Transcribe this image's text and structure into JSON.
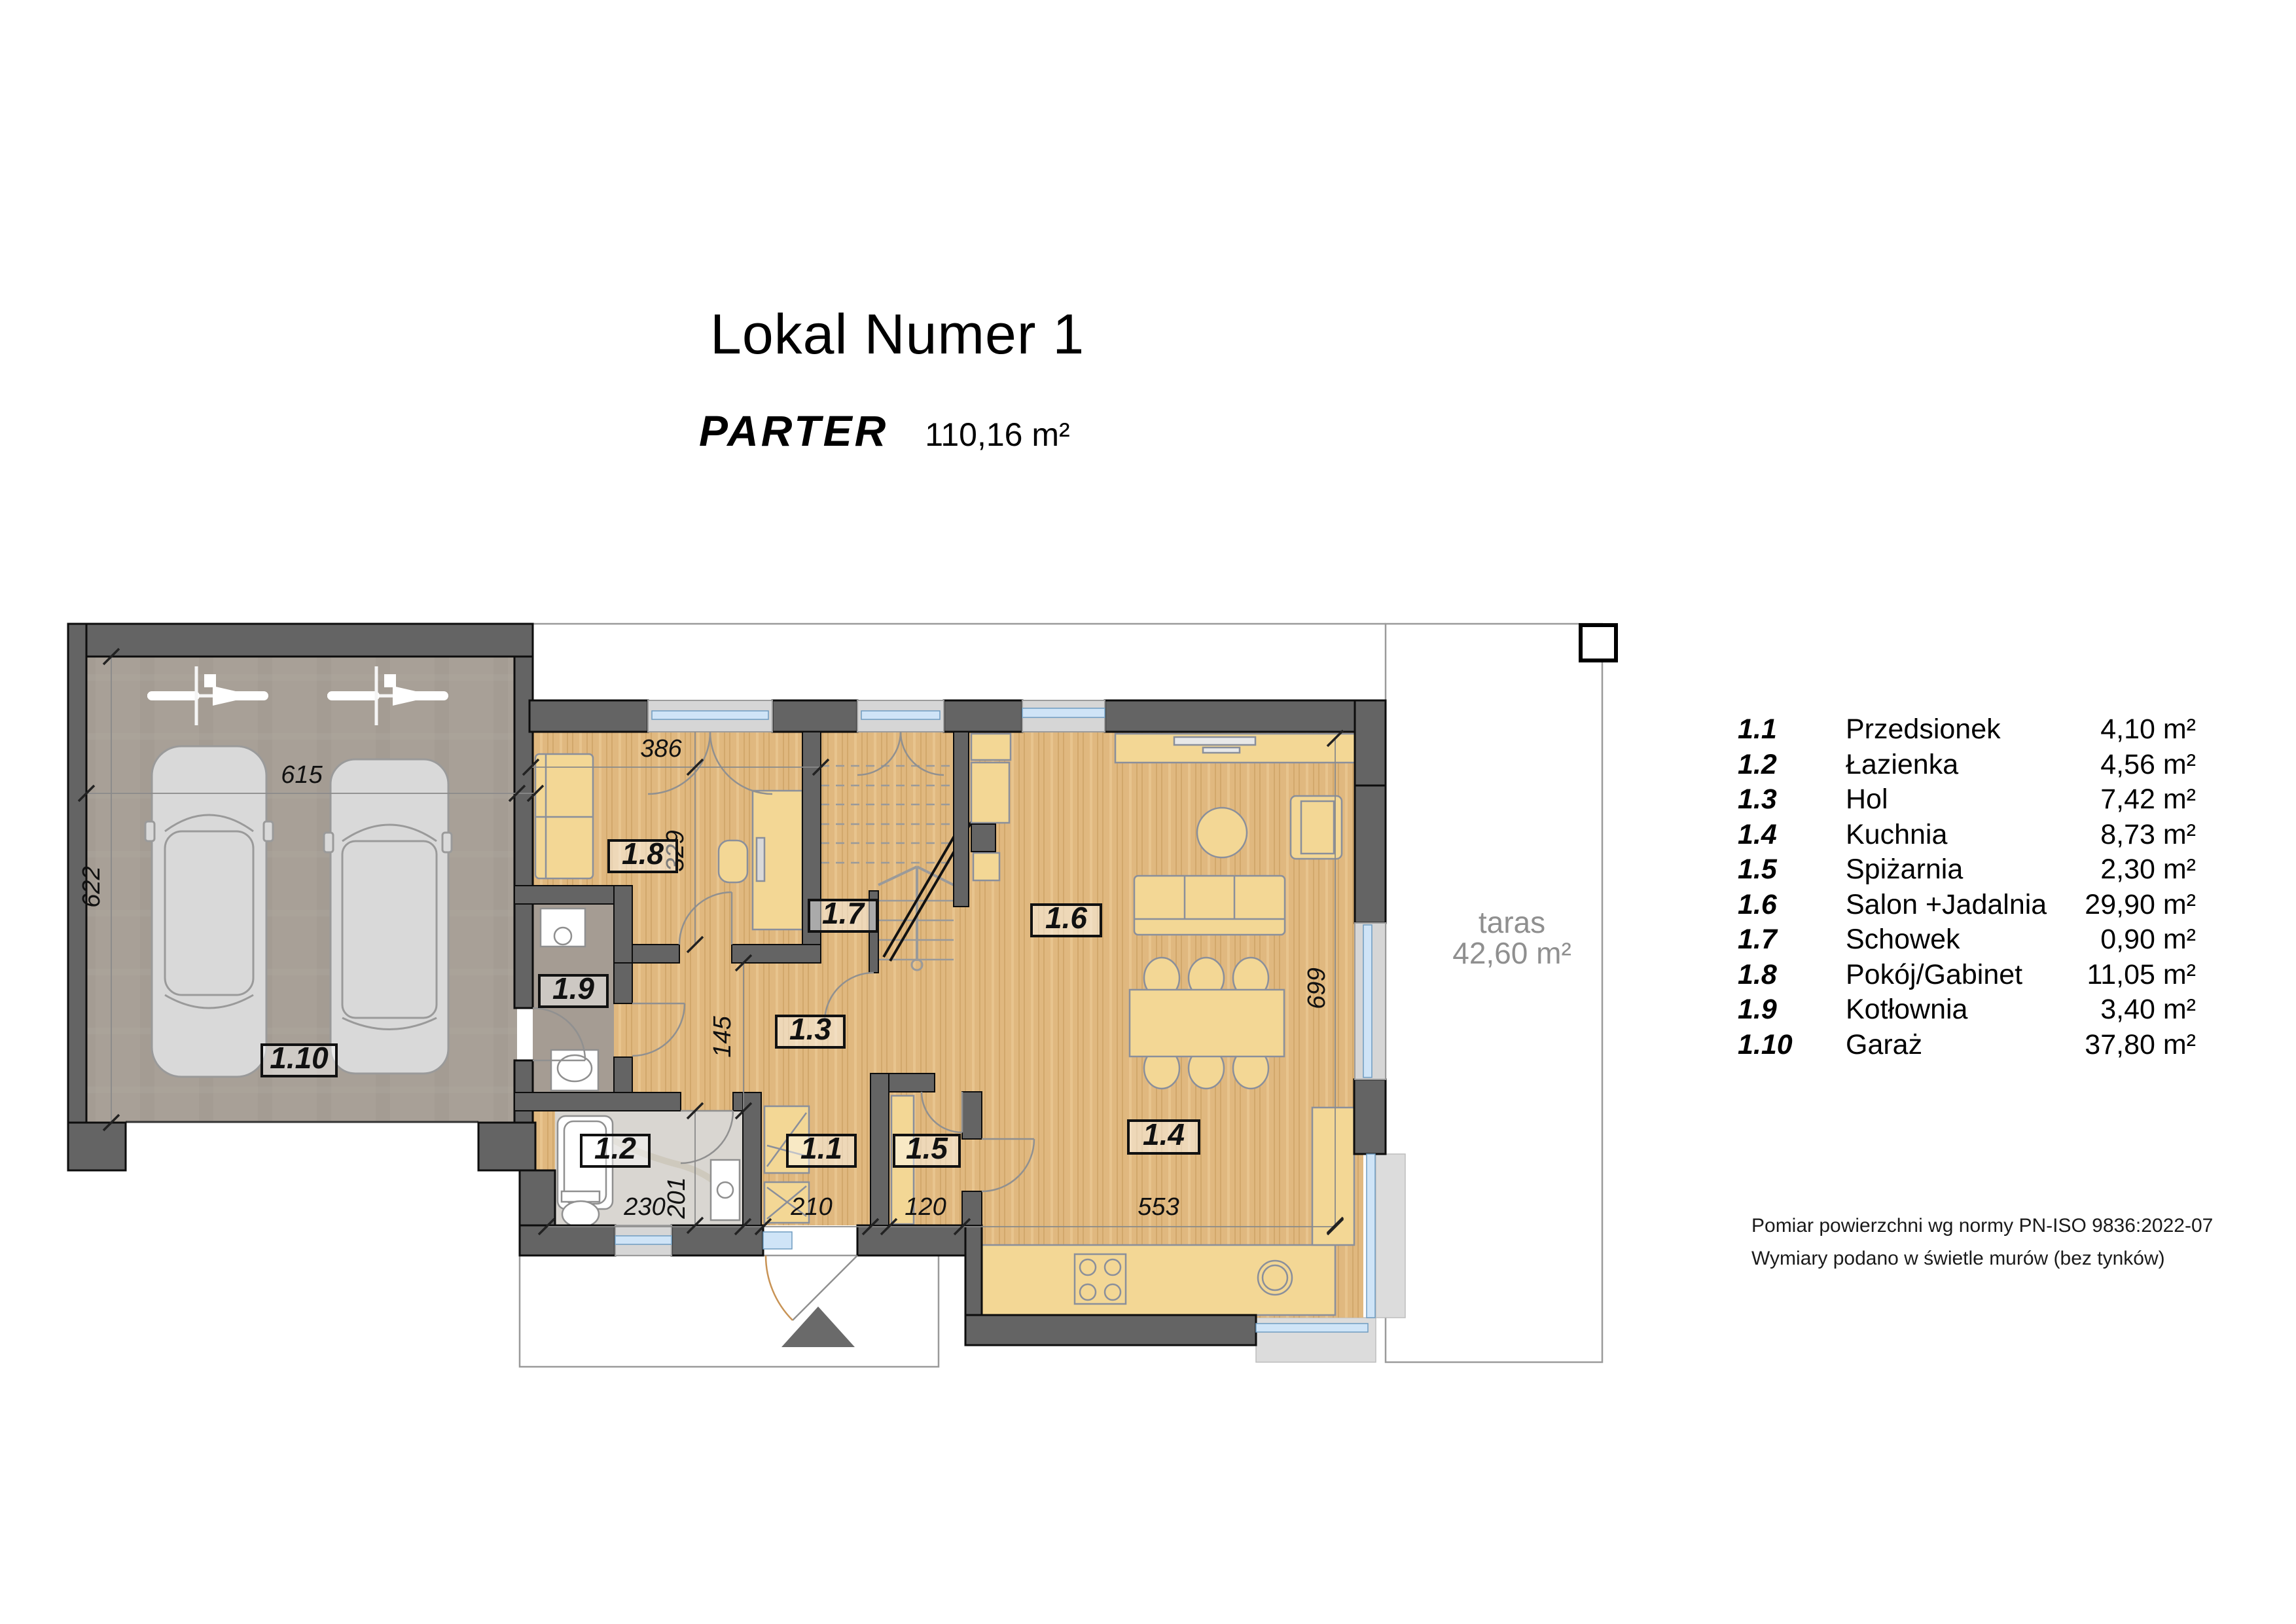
{
  "header": {
    "title": "Lokal Numer 1",
    "floor_label": "PARTER",
    "floor_area": "110,16 m²"
  },
  "legend": {
    "rows": [
      {
        "no": "1.1",
        "name": "Przedsionek",
        "area": "4,10 m²"
      },
      {
        "no": "1.2",
        "name": "Łazienka",
        "area": "4,56 m²"
      },
      {
        "no": "1.3",
        "name": "Hol",
        "area": "7,42 m²"
      },
      {
        "no": "1.4",
        "name": "Kuchnia",
        "area": "8,73 m²"
      },
      {
        "no": "1.5",
        "name": "Spiżarnia",
        "area": "2,30 m²"
      },
      {
        "no": "1.6",
        "name": "Salon +Jadalnia",
        "area": "29,90 m²"
      },
      {
        "no": "1.7",
        "name": "Schowek",
        "area": "0,90 m²"
      },
      {
        "no": "1.8",
        "name": "Pokój/Gabinet",
        "area": "11,05 m²"
      },
      {
        "no": "1.9",
        "name": "Kotłownia",
        "area": "3,40 m²"
      },
      {
        "no": "1.10",
        "name": "Garaż",
        "area": "37,80 m²"
      }
    ]
  },
  "notes": {
    "line1": "Pomiar powierzchni wg normy PN-ISO 9836:2022-07",
    "line2": "Wymiary podano w świetle murów (bez tynków)"
  },
  "plan": {
    "labels": {
      "garage": "1.10",
      "office": "1.8",
      "boiler": "1.9",
      "bathroom": "1.2",
      "hall": "1.3",
      "storage": "1.7",
      "vestibule": "1.1",
      "pantry": "1.5",
      "living": "1.6",
      "kitchen": "1.4"
    },
    "terrace": {
      "name": "taras",
      "area": "42,60 m²"
    },
    "dimensions": {
      "garage_w": "615",
      "garage_h": "622",
      "office_w": "386",
      "office_h": "329",
      "hall_w": "145",
      "bath_w": "230",
      "bath_d": "201",
      "vestibule_w": "210",
      "pantry_w": "120",
      "kitchen_w": "553",
      "living_h": "699"
    }
  },
  "colors": {
    "wall": "#646464",
    "wood_floor": "#e0b87f",
    "garage_floor": "#a8a097",
    "boiler_floor": "#a59c93",
    "bath_floor": "#d9d6d1",
    "furniture": "#f3d795",
    "glass": "#cfe4f7",
    "paving": "#dcdcdc",
    "car": "#d9d9d9"
  }
}
